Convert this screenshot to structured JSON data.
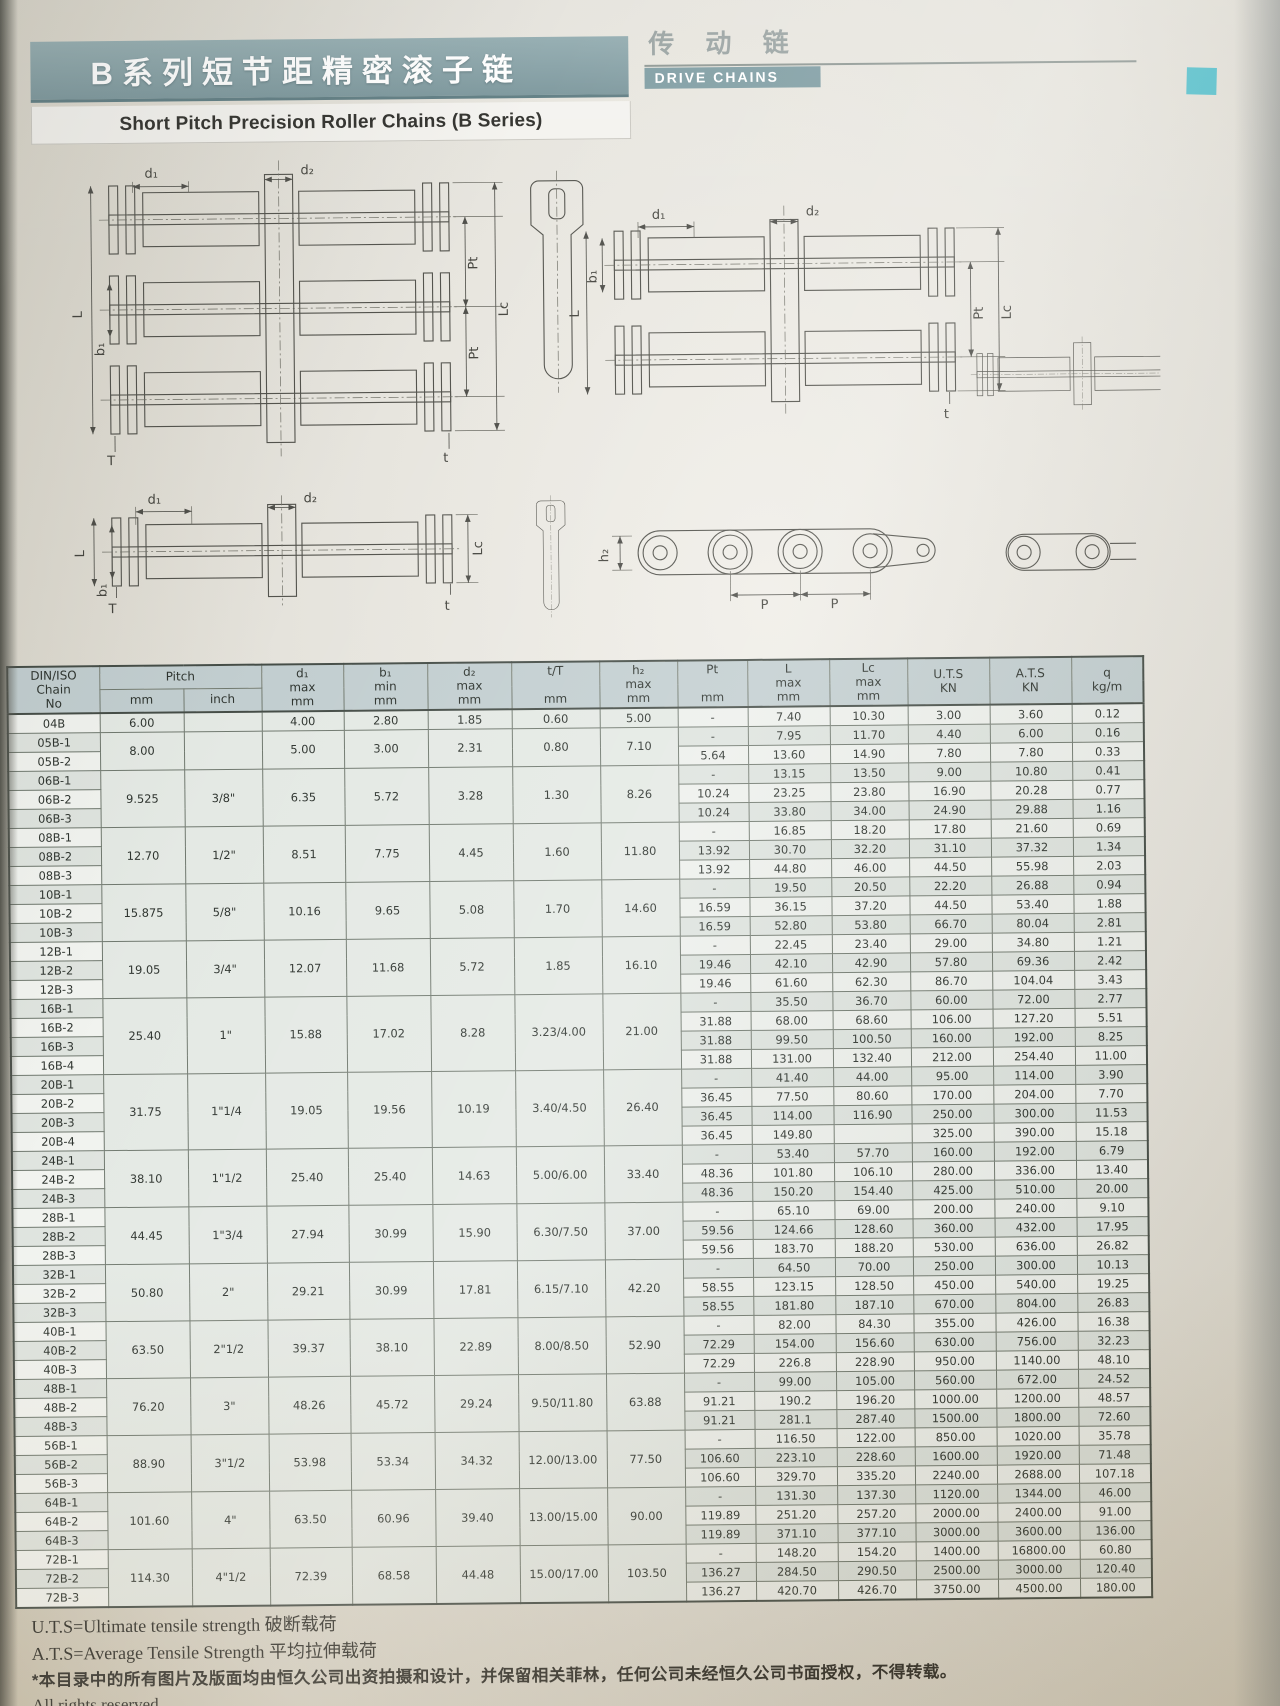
{
  "header": {
    "title_cn": "B系列短节距精密滚子链",
    "title_en": "Short Pitch Precision Roller Chains (B Series)",
    "category_cn": "传 动 链",
    "category_en": "DRIVE CHAINS"
  },
  "diagram_labels": {
    "d1": "d₁",
    "d2": "d₂",
    "b1": "b₁",
    "L": "L",
    "Lc": "Lc",
    "Pt": "Pt",
    "T": "T",
    "t": "t",
    "h2": "h₂",
    "P": "P"
  },
  "footer": {
    "note_uts": "U.T.S=Ultimate tensile strength 破断载荷",
    "note_ats": "A.T.S=Average Tensile Strength 平均拉伸载荷",
    "copyright_cn": "*本目录中的所有图片及版面均由恒久公司出资拍摄和设计，并保留相关菲林，任何公司未经恒久公司书面授权，不得转载。",
    "copyright_en": "All rights reserved"
  },
  "table": {
    "header": {
      "chain_no": [
        "DIN/ISO",
        "Chain",
        "No"
      ],
      "pitch": "Pitch",
      "pitch_sub": [
        "mm",
        "inch"
      ],
      "columns": [
        {
          "key": "d1",
          "lines": [
            "d₁",
            "max",
            "mm"
          ]
        },
        {
          "key": "b1",
          "lines": [
            "b₁",
            "min",
            "mm"
          ]
        },
        {
          "key": "d2",
          "lines": [
            "d₂",
            "max",
            "mm"
          ]
        },
        {
          "key": "tt",
          "lines": [
            "t/T",
            "",
            "mm"
          ]
        },
        {
          "key": "h2",
          "lines": [
            "h₂",
            "max",
            "mm"
          ]
        },
        {
          "key": "pt",
          "lines": [
            "Pt",
            "",
            "mm"
          ]
        },
        {
          "key": "l",
          "lines": [
            "L",
            "max",
            "mm"
          ]
        },
        {
          "key": "lc",
          "lines": [
            "Lc",
            "max",
            "mm"
          ]
        },
        {
          "key": "uts",
          "lines": [
            "U.T.S",
            "KN"
          ]
        },
        {
          "key": "ats",
          "lines": [
            "A.T.S",
            "KN"
          ]
        },
        {
          "key": "q",
          "lines": [
            "q",
            "kg/m"
          ]
        }
      ]
    },
    "groups": [
      {
        "pitch_mm": "6.00",
        "pitch_inch": "",
        "d1": "4.00",
        "b1": "2.80",
        "d2": "1.85",
        "tT": "0.60",
        "h2": "5.00",
        "rows": [
          {
            "no": "04B",
            "pt": "-",
            "L": "7.40",
            "Lc": "10.30",
            "uts": "3.00",
            "ats": "3.60",
            "q": "0.12"
          }
        ]
      },
      {
        "pitch_mm": "8.00",
        "pitch_inch": "",
        "d1": "5.00",
        "b1": "3.00",
        "d2": "2.31",
        "tT": "0.80",
        "h2": "7.10",
        "rows": [
          {
            "no": "05B-1",
            "pt": "-",
            "L": "7.95",
            "Lc": "11.70",
            "uts": "4.40",
            "ats": "6.00",
            "q": "0.16"
          },
          {
            "no": "05B-2",
            "pt": "5.64",
            "L": "13.60",
            "Lc": "14.90",
            "uts": "7.80",
            "ats": "7.80",
            "q": "0.33"
          }
        ]
      },
      {
        "pitch_mm": "9.525",
        "pitch_inch": "3/8\"",
        "d1": "6.35",
        "b1": "5.72",
        "d2": "3.28",
        "tT": "1.30",
        "h2": "8.26",
        "rows": [
          {
            "no": "06B-1",
            "pt": "-",
            "L": "13.15",
            "Lc": "13.50",
            "uts": "9.00",
            "ats": "10.80",
            "q": "0.41"
          },
          {
            "no": "06B-2",
            "pt": "10.24",
            "L": "23.25",
            "Lc": "23.80",
            "uts": "16.90",
            "ats": "20.28",
            "q": "0.77"
          },
          {
            "no": "06B-3",
            "pt": "10.24",
            "L": "33.80",
            "Lc": "34.00",
            "uts": "24.90",
            "ats": "29.88",
            "q": "1.16"
          }
        ]
      },
      {
        "pitch_mm": "12.70",
        "pitch_inch": "1/2\"",
        "d1": "8.51",
        "b1": "7.75",
        "d2": "4.45",
        "tT": "1.60",
        "h2": "11.80",
        "rows": [
          {
            "no": "08B-1",
            "pt": "-",
            "L": "16.85",
            "Lc": "18.20",
            "uts": "17.80",
            "ats": "21.60",
            "q": "0.69"
          },
          {
            "no": "08B-2",
            "pt": "13.92",
            "L": "30.70",
            "Lc": "32.20",
            "uts": "31.10",
            "ats": "37.32",
            "q": "1.34"
          },
          {
            "no": "08B-3",
            "pt": "13.92",
            "L": "44.80",
            "Lc": "46.00",
            "uts": "44.50",
            "ats": "55.98",
            "q": "2.03"
          }
        ]
      },
      {
        "pitch_mm": "15.875",
        "pitch_inch": "5/8\"",
        "d1": "10.16",
        "b1": "9.65",
        "d2": "5.08",
        "tT": "1.70",
        "h2": "14.60",
        "rows": [
          {
            "no": "10B-1",
            "pt": "-",
            "L": "19.50",
            "Lc": "20.50",
            "uts": "22.20",
            "ats": "26.88",
            "q": "0.94"
          },
          {
            "no": "10B-2",
            "pt": "16.59",
            "L": "36.15",
            "Lc": "37.20",
            "uts": "44.50",
            "ats": "53.40",
            "q": "1.88"
          },
          {
            "no": "10B-3",
            "pt": "16.59",
            "L": "52.80",
            "Lc": "53.80",
            "uts": "66.70",
            "ats": "80.04",
            "q": "2.81"
          }
        ]
      },
      {
        "pitch_mm": "19.05",
        "pitch_inch": "3/4\"",
        "d1": "12.07",
        "b1": "11.68",
        "d2": "5.72",
        "tT": "1.85",
        "h2": "16.10",
        "rows": [
          {
            "no": "12B-1",
            "pt": "-",
            "L": "22.45",
            "Lc": "23.40",
            "uts": "29.00",
            "ats": "34.80",
            "q": "1.21"
          },
          {
            "no": "12B-2",
            "pt": "19.46",
            "L": "42.10",
            "Lc": "42.90",
            "uts": "57.80",
            "ats": "69.36",
            "q": "2.42"
          },
          {
            "no": "12B-3",
            "pt": "19.46",
            "L": "61.60",
            "Lc": "62.30",
            "uts": "86.70",
            "ats": "104.04",
            "q": "3.43"
          }
        ]
      },
      {
        "pitch_mm": "25.40",
        "pitch_inch": "1\"",
        "d1": "15.88",
        "b1": "17.02",
        "d2": "8.28",
        "tT": "3.23/4.00",
        "h2": "21.00",
        "rows": [
          {
            "no": "16B-1",
            "pt": "-",
            "L": "35.50",
            "Lc": "36.70",
            "uts": "60.00",
            "ats": "72.00",
            "q": "2.77"
          },
          {
            "no": "16B-2",
            "pt": "31.88",
            "L": "68.00",
            "Lc": "68.60",
            "uts": "106.00",
            "ats": "127.20",
            "q": "5.51"
          },
          {
            "no": "16B-3",
            "pt": "31.88",
            "L": "99.50",
            "Lc": "100.50",
            "uts": "160.00",
            "ats": "192.00",
            "q": "8.25"
          },
          {
            "no": "16B-4",
            "pt": "31.88",
            "L": "131.00",
            "Lc": "132.40",
            "uts": "212.00",
            "ats": "254.40",
            "q": "11.00"
          }
        ]
      },
      {
        "pitch_mm": "31.75",
        "pitch_inch": "1\"1/4",
        "d1": "19.05",
        "b1": "19.56",
        "d2": "10.19",
        "tT": "3.40/4.50",
        "h2": "26.40",
        "rows": [
          {
            "no": "20B-1",
            "pt": "-",
            "L": "41.40",
            "Lc": "44.00",
            "uts": "95.00",
            "ats": "114.00",
            "q": "3.90"
          },
          {
            "no": "20B-2",
            "pt": "36.45",
            "L": "77.50",
            "Lc": "80.60",
            "uts": "170.00",
            "ats": "204.00",
            "q": "7.70"
          },
          {
            "no": "20B-3",
            "pt": "36.45",
            "L": "114.00",
            "Lc": "116.90",
            "uts": "250.00",
            "ats": "300.00",
            "q": "11.53"
          },
          {
            "no": "20B-4",
            "pt": "36.45",
            "L": "149.80",
            "Lc": "",
            "uts": "325.00",
            "ats": "390.00",
            "q": "15.18"
          }
        ]
      },
      {
        "pitch_mm": "38.10",
        "pitch_inch": "1\"1/2",
        "d1": "25.40",
        "b1": "25.40",
        "d2": "14.63",
        "tT": "5.00/6.00",
        "h2": "33.40",
        "rows": [
          {
            "no": "24B-1",
            "pt": "-",
            "L": "53.40",
            "Lc": "57.70",
            "uts": "160.00",
            "ats": "192.00",
            "q": "6.79"
          },
          {
            "no": "24B-2",
            "pt": "48.36",
            "L": "101.80",
            "Lc": "106.10",
            "uts": "280.00",
            "ats": "336.00",
            "q": "13.40"
          },
          {
            "no": "24B-3",
            "pt": "48.36",
            "L": "150.20",
            "Lc": "154.40",
            "uts": "425.00",
            "ats": "510.00",
            "q": "20.00"
          }
        ]
      },
      {
        "pitch_mm": "44.45",
        "pitch_inch": "1\"3/4",
        "d1": "27.94",
        "b1": "30.99",
        "d2": "15.90",
        "tT": "6.30/7.50",
        "h2": "37.00",
        "rows": [
          {
            "no": "28B-1",
            "pt": "-",
            "L": "65.10",
            "Lc": "69.00",
            "uts": "200.00",
            "ats": "240.00",
            "q": "9.10"
          },
          {
            "no": "28B-2",
            "pt": "59.56",
            "L": "124.66",
            "Lc": "128.60",
            "uts": "360.00",
            "ats": "432.00",
            "q": "17.95"
          },
          {
            "no": "28B-3",
            "pt": "59.56",
            "L": "183.70",
            "Lc": "188.20",
            "uts": "530.00",
            "ats": "636.00",
            "q": "26.82"
          }
        ]
      },
      {
        "pitch_mm": "50.80",
        "pitch_inch": "2\"",
        "d1": "29.21",
        "b1": "30.99",
        "d2": "17.81",
        "tT": "6.15/7.10",
        "h2": "42.20",
        "rows": [
          {
            "no": "32B-1",
            "pt": "-",
            "L": "64.50",
            "Lc": "70.00",
            "uts": "250.00",
            "ats": "300.00",
            "q": "10.13"
          },
          {
            "no": "32B-2",
            "pt": "58.55",
            "L": "123.15",
            "Lc": "128.50",
            "uts": "450.00",
            "ats": "540.00",
            "q": "19.25"
          },
          {
            "no": "32B-3",
            "pt": "58.55",
            "L": "181.80",
            "Lc": "187.10",
            "uts": "670.00",
            "ats": "804.00",
            "q": "26.83"
          }
        ]
      },
      {
        "pitch_mm": "63.50",
        "pitch_inch": "2\"1/2",
        "d1": "39.37",
        "b1": "38.10",
        "d2": "22.89",
        "tT": "8.00/8.50",
        "h2": "52.90",
        "rows": [
          {
            "no": "40B-1",
            "pt": "-",
            "L": "82.00",
            "Lc": "84.30",
            "uts": "355.00",
            "ats": "426.00",
            "q": "16.38"
          },
          {
            "no": "40B-2",
            "pt": "72.29",
            "L": "154.00",
            "Lc": "156.60",
            "uts": "630.00",
            "ats": "756.00",
            "q": "32.23"
          },
          {
            "no": "40B-3",
            "pt": "72.29",
            "L": "226.8",
            "Lc": "228.90",
            "uts": "950.00",
            "ats": "1140.00",
            "q": "48.10"
          }
        ]
      },
      {
        "pitch_mm": "76.20",
        "pitch_inch": "3\"",
        "d1": "48.26",
        "b1": "45.72",
        "d2": "29.24",
        "tT": "9.50/11.80",
        "h2": "63.88",
        "rows": [
          {
            "no": "48B-1",
            "pt": "-",
            "L": "99.00",
            "Lc": "105.00",
            "uts": "560.00",
            "ats": "672.00",
            "q": "24.52"
          },
          {
            "no": "48B-2",
            "pt": "91.21",
            "L": "190.2",
            "Lc": "196.20",
            "uts": "1000.00",
            "ats": "1200.00",
            "q": "48.57"
          },
          {
            "no": "48B-3",
            "pt": "91.21",
            "L": "281.1",
            "Lc": "287.40",
            "uts": "1500.00",
            "ats": "1800.00",
            "q": "72.60"
          }
        ]
      },
      {
        "pitch_mm": "88.90",
        "pitch_inch": "3\"1/2",
        "d1": "53.98",
        "b1": "53.34",
        "d2": "34.32",
        "tT": "12.00/13.00",
        "h2": "77.50",
        "rows": [
          {
            "no": "56B-1",
            "pt": "-",
            "L": "116.50",
            "Lc": "122.00",
            "uts": "850.00",
            "ats": "1020.00",
            "q": "35.78"
          },
          {
            "no": "56B-2",
            "pt": "106.60",
            "L": "223.10",
            "Lc": "228.60",
            "uts": "1600.00",
            "ats": "1920.00",
            "q": "71.48"
          },
          {
            "no": "56B-3",
            "pt": "106.60",
            "L": "329.70",
            "Lc": "335.20",
            "uts": "2240.00",
            "ats": "2688.00",
            "q": "107.18"
          }
        ]
      },
      {
        "pitch_mm": "101.60",
        "pitch_inch": "4\"",
        "d1": "63.50",
        "b1": "60.96",
        "d2": "39.40",
        "tT": "13.00/15.00",
        "h2": "90.00",
        "rows": [
          {
            "no": "64B-1",
            "pt": "-",
            "L": "131.30",
            "Lc": "137.30",
            "uts": "1120.00",
            "ats": "1344.00",
            "q": "46.00"
          },
          {
            "no": "64B-2",
            "pt": "119.89",
            "L": "251.20",
            "Lc": "257.20",
            "uts": "2000.00",
            "ats": "2400.00",
            "q": "91.00"
          },
          {
            "no": "64B-3",
            "pt": "119.89",
            "L": "371.10",
            "Lc": "377.10",
            "uts": "3000.00",
            "ats": "3600.00",
            "q": "136.00"
          }
        ]
      },
      {
        "pitch_mm": "114.30",
        "pitch_inch": "4\"1/2",
        "d1": "72.39",
        "b1": "68.58",
        "d2": "44.48",
        "tT": "15.00/17.00",
        "h2": "103.50",
        "rows": [
          {
            "no": "72B-1",
            "pt": "-",
            "L": "148.20",
            "Lc": "154.20",
            "uts": "1400.00",
            "ats": "16800.00",
            "q": "60.80"
          },
          {
            "no": "72B-2",
            "pt": "136.27",
            "L": "284.50",
            "Lc": "290.50",
            "uts": "2500.00",
            "ats": "3000.00",
            "q": "120.40"
          },
          {
            "no": "72B-3",
            "pt": "136.27",
            "L": "420.70",
            "Lc": "426.70",
            "uts": "3750.00",
            "ats": "4500.00",
            "q": "180.00"
          }
        ]
      }
    ]
  }
}
